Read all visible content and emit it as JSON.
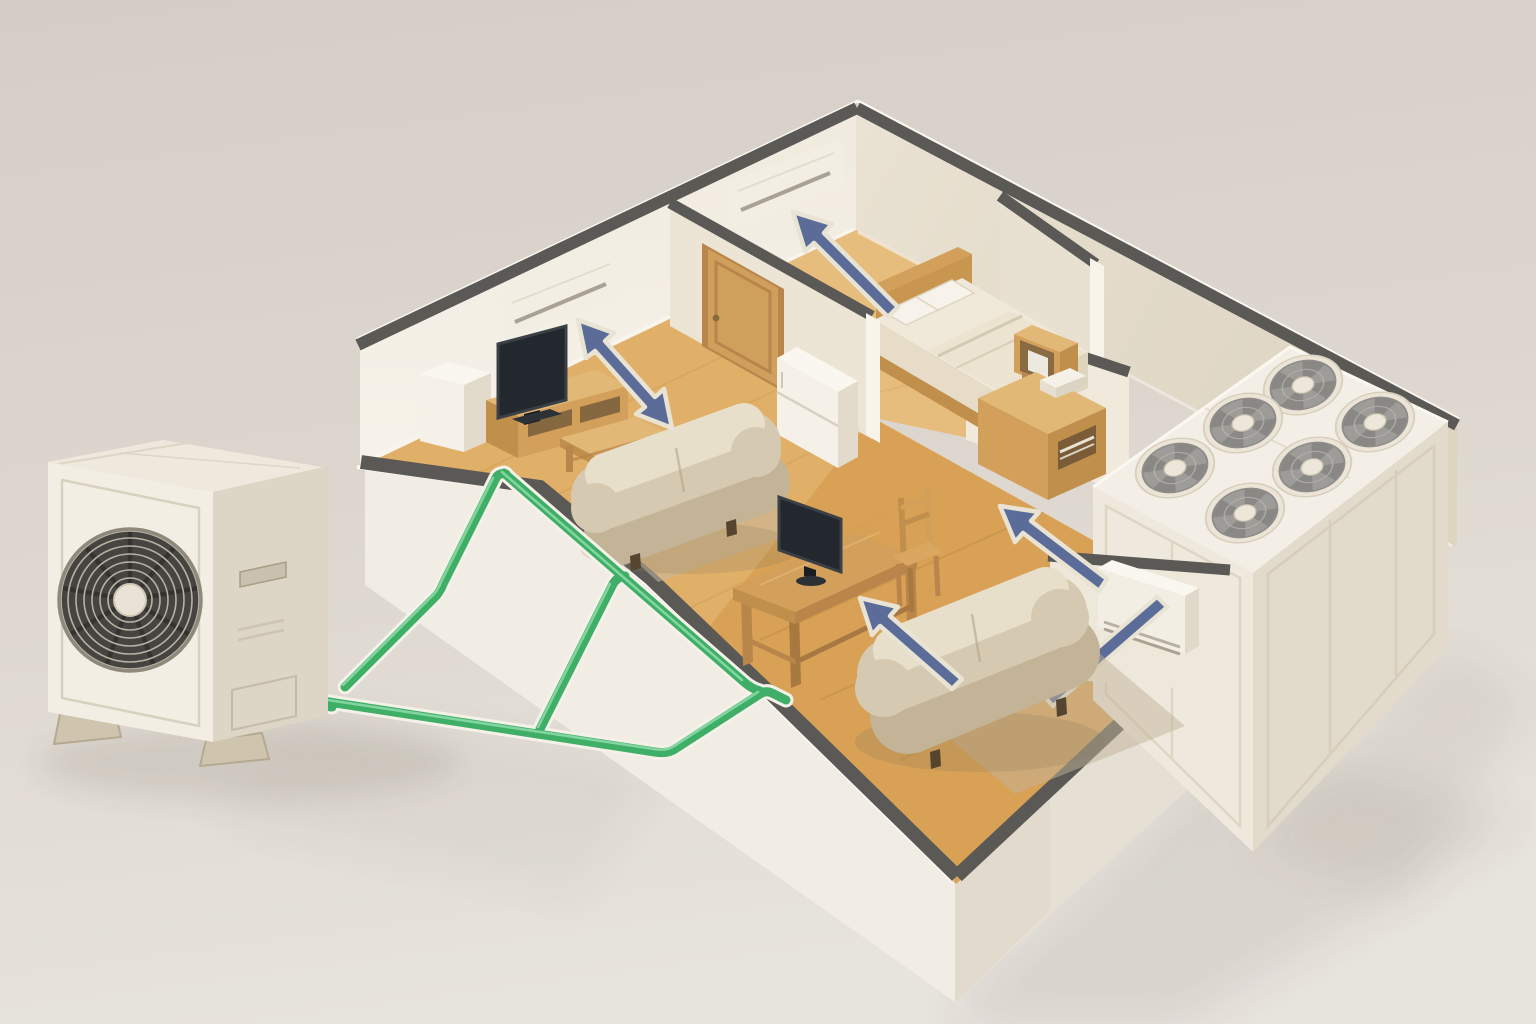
{
  "scene": {
    "type": "3d-isometric-cutaway-illustration",
    "subject": "Multi-split air conditioning system serving a furnished apartment",
    "visible_text": "none",
    "components": [
      "outdoor condenser unit",
      "green refrigerant piping",
      "three indoor AC units",
      "rooftop fan bank",
      "blue airflow arrows",
      "cutaway apartment with furniture"
    ]
  },
  "colors": {
    "bg_top": "#d5cec6",
    "bg_mid": "#ddd7cf",
    "bg_bottom": "#e7e3dd",
    "slab_left": "#f1ece4",
    "slab_right": "#e6dfd3",
    "edge_dark": "#5a5955",
    "edge_light": "#fbf8f1",
    "wall_lit": "#f4efe6",
    "wall_shade": "#e3dbcb",
    "wall_mid": "#ece4d4",
    "wall_cap": "#f8f4ea",
    "floor_living": "#e0b069",
    "floor_bedroom": "#e7bd7e",
    "floor_dining": "#d69f52",
    "plank": "#a87428",
    "wood": "#d3a05b",
    "wood_dark": "#b9854a",
    "wood_light": "#e2b876",
    "wood_side": "#c08f4c",
    "sofa": "#d6c9b1",
    "sofa_dark": "#c3b497",
    "sofa_light": "#e8dfca",
    "tv": "#23282e",
    "tv_frame": "#3a4046",
    "white_goods": "#f5f1e8",
    "white_goods_side": "#e2dbcc",
    "white_goods_top": "#faf7f0",
    "unit_body": "#f3eee4",
    "unit_shade": "#ddd5c5",
    "unit_slot": "#a9a294",
    "grille_bg": "#454440",
    "grille_ring": "#b7b1a4",
    "grille_hub": "#e9e3d5",
    "fan_rim": "#ece5d7",
    "fan_blade": "#9e9c98",
    "fan_blade_dark": "#8a8884",
    "fan_hub": "#ede7da",
    "pipe": "#3fae67",
    "pipe_light": "#8fdcab",
    "pipe_outline": "#f4f1e9",
    "arrow": "#5b6c98",
    "arrow_outline": "#e9e3d4",
    "shadow": "#8d8478",
    "rug": "#c6b89e",
    "door_wood": "#cfa05c",
    "door_frame": "#b9854a",
    "bed_sheet": "#f0e9da",
    "bed_blanket": "#ece3d1"
  },
  "outdoor_unit": {
    "kind": "outdoor condenser",
    "grille_rings": 7,
    "grille_spokes": 9,
    "feet": 2,
    "pipe_stubs": 2
  },
  "refrigerant_piping": {
    "color_hex": "#3fae67",
    "risers": 2,
    "trunk_route": "from outdoor unit across ground, up and along floor edge into apartment"
  },
  "rooftop_unit": {
    "fan_count": 6,
    "rows": 2,
    "fans_per_row": 3
  },
  "airflow_arrows": {
    "count": 5,
    "double_headed": 1,
    "color_hex": "#5b6c98"
  },
  "rooms": [
    {
      "name": "living-room",
      "indoor_unit": "wall-mounted",
      "items": [
        "wall AC unit",
        "TV",
        "TV stand",
        "white cabinet",
        "coffee table",
        "sofa",
        "rug",
        "refrigerator",
        "door"
      ]
    },
    {
      "name": "bedroom",
      "indoor_unit": "wall-mounted",
      "items": [
        "wall AC unit",
        "double bed",
        "two pillows",
        "wall cube shelf",
        "desk"
      ]
    },
    {
      "name": "dining-room",
      "indoor_unit": "wall-console",
      "items": [
        "dining table",
        "TV",
        "chair",
        "sofa",
        "rug",
        "console AC unit"
      ]
    }
  ]
}
